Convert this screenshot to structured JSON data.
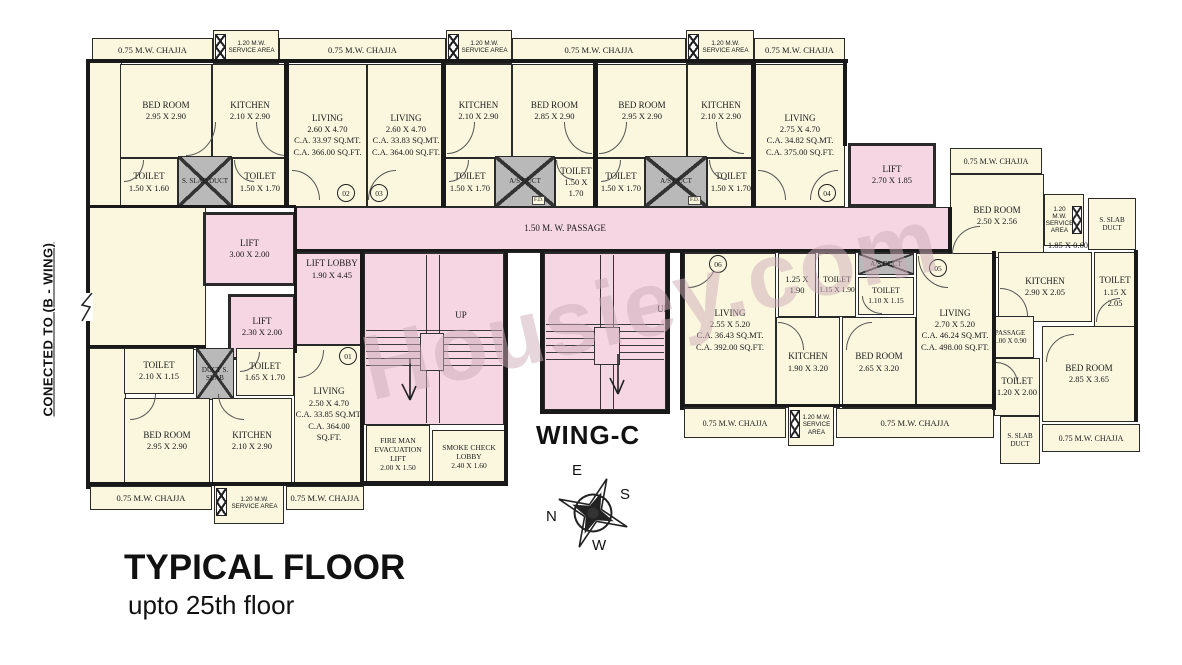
{
  "title": {
    "main": "TYPICAL FLOOR",
    "sub": "upto 25th floor"
  },
  "wing_label": "WING-C",
  "connected_label": "CONECTED TO (B - WING)",
  "watermark": "Housiey.com",
  "labels": {
    "chajja": "0.75 M.W. CHAJJA",
    "service_area": "1.20 M.W. SERVICE AREA",
    "passage": "1.50 M. W. PASSAGE",
    "up": "UP",
    "fd": "F.D.",
    "dim_service_right": "1.85 X 0.60"
  },
  "units": {
    "u1": "01",
    "u2": "02",
    "u3": "03",
    "u4": "04",
    "u5": "05",
    "u6": "06"
  },
  "compass": {
    "n": "N",
    "e": "E",
    "s": "S",
    "w": "W"
  },
  "rooms": [
    {
      "name": "BED ROOM",
      "dims": "2.95 X 2.90"
    },
    {
      "name": "KITCHEN",
      "dims": "2.10 X 2.90"
    },
    {
      "name": "TOILET",
      "dims": "1.50 X 1.60"
    },
    {
      "name": "S. SLAB DUCT"
    },
    {
      "name": "TOILET",
      "dims": "1.50 X 1.70"
    },
    {
      "name": "LIVING",
      "dims": "2.60 X 4.70",
      "area_mt": "C.A. 33.97 SQ.MT.",
      "area_ft": "C.A. 366.00 SQ.FT."
    },
    {
      "name": "LIVING",
      "dims": "2.60 X 4.70",
      "area_mt": "C.A. 33.83 SQ.MT.",
      "area_ft": "C.A. 364.00 SQ.FT."
    },
    {
      "name": "KITCHEN",
      "dims": "2.10 X 2.90"
    },
    {
      "name": "BED ROOM",
      "dims": "2.85 X 2.90"
    },
    {
      "name": "TOILET",
      "dims": "1.50 X 1.70"
    },
    {
      "name": "A/S DUCT"
    },
    {
      "name": "TOILET",
      "dims": "1.50 X 1.70"
    },
    {
      "name": "BED ROOM",
      "dims": "2.95 X 2.90"
    },
    {
      "name": "KITCHEN",
      "dims": "2.10 X 2.90"
    },
    {
      "name": "TOILET",
      "dims": "1.50 X 1.70"
    },
    {
      "name": "A/S DUCT"
    },
    {
      "name": "TOILET",
      "dims": "1.50 X 1.70"
    },
    {
      "name": "LIVING",
      "dims": "2.75 X 4.70",
      "area_mt": "C.A. 34.82 SQ.MT.",
      "area_ft": "C.A. 375.00 SQ.FT."
    },
    {
      "name": "LIFT",
      "dims": "2.70 X 1.85"
    },
    {
      "name": "BED ROOM",
      "dims": "2.50 X 2.56"
    },
    {
      "name": "S. SLAB DUCT"
    },
    {
      "name": "KITCHEN",
      "dims": "2.90 X 2.05"
    },
    {
      "name": "TOILET",
      "dims": "1.15 X 2.05"
    },
    {
      "name": "PASSAGE",
      "dims": "1.00 X 0.90"
    },
    {
      "name": "TOILET",
      "dims": "1.20 X 2.00"
    },
    {
      "name": "BED ROOM",
      "dims": "2.85 X 3.65"
    },
    {
      "name": "S. SLAB DUCT"
    },
    {
      "name": "LIFT",
      "dims": "3.00 X 2.00"
    },
    {
      "name": "LIFT",
      "dims": "2.30 X 2.00"
    },
    {
      "name": "LIFT LOBBY",
      "dims": "1.90 X 4.45"
    },
    {
      "name": "FIRE MAN EVACUATION LIFT",
      "dims": "2.00 X 1.50"
    },
    {
      "name": "SMOKE CHECK LOBBY",
      "dims": "2.40 X 1.60"
    },
    {
      "name": "LIVING",
      "dims": "2.55 X 5.20",
      "area_mt": "C.A. 36.43 SQ.MT.",
      "area_ft": "C.A. 392.00 SQ.FT."
    },
    {
      "name": "",
      "dims": "1.25 X 1.90"
    },
    {
      "name": "TOILET",
      "dims": "1.15 X 1.90"
    },
    {
      "name": "A/S DUCT"
    },
    {
      "name": "TOILET",
      "dims": "1.10 X 1.15"
    },
    {
      "name": "LIVING",
      "dims": "2.70 X 5.20",
      "area_mt": "C.A. 46.24 SQ.MT.",
      "area_ft": "C.A. 498.00 SQ.FT."
    },
    {
      "name": "KITCHEN",
      "dims": "1.90 X 3.20"
    },
    {
      "name": "BED ROOM",
      "dims": "2.65 X 3.20"
    },
    {
      "name": "TOILET",
      "dims": "2.10 X 1.15"
    },
    {
      "name": "DUCT S. SLAB"
    },
    {
      "name": "TOILET",
      "dims": "1.65 X 1.70"
    },
    {
      "name": "BED ROOM",
      "dims": "2.95 X 2.90"
    },
    {
      "name": "KITCHEN",
      "dims": "2.10 X 2.90"
    },
    {
      "name": "LIVING",
      "dims": "2.50 X 4.70",
      "area_mt": "C.A. 33.85 SQ.MT.",
      "area_ft": "C.A. 364.00 SQ.FT."
    }
  ]
}
